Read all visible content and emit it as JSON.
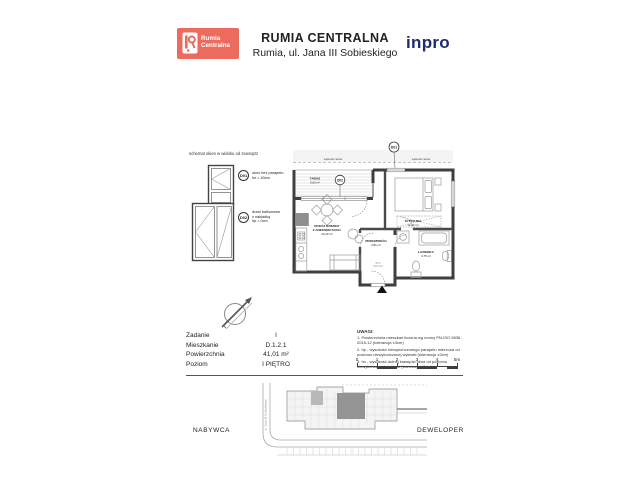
{
  "header": {
    "logo_line1": "Rumia",
    "logo_line2": "Centralna",
    "title": "RUMIA CENTRALNA",
    "subtitle": "Rumia, ul. Jana III Sobieskiego",
    "brand": "inpro"
  },
  "schematics": {
    "caption": "schemat okien w widoku od zewnątrz",
    "win1": {
      "code": "D01",
      "note1": "okno bez parapetu",
      "note2": "hn = 40cm"
    },
    "win2": {
      "code": "D02",
      "note1": "drzwi balkonowe",
      "note2": "z nakładką",
      "note3": "hp = 0cm"
    }
  },
  "plan": {
    "neighbor_left": "sąsiedni taras",
    "neighbor_right": "sąsiedni taras",
    "code_d01": "D01",
    "code_d02": "D02",
    "rooms": {
      "taras": {
        "name": "TARAS",
        "area": "5,60 m²"
      },
      "living": {
        "name1": "POKÓJ DZIENNY",
        "name2": "Z ANEKSEM KUCH.",
        "area": "20,43 m²"
      },
      "sypialnia": {
        "name": "SYPIALNIA",
        "area": "12,02 m²"
      },
      "przedpokoj": {
        "name": "PRZEDPOKÓJ",
        "area": "3,81 m²"
      },
      "lazienka": {
        "name": "ŁAZIENKA",
        "area": "4,75 m²"
      }
    },
    "entrance_line1": "drzwi",
    "entrance_line2": "wejściowe"
  },
  "table": {
    "rows": [
      {
        "label": "Zadanie",
        "value": "I"
      },
      {
        "label": "Mieszkanie",
        "value": "D.1.2.1"
      },
      {
        "label": "Powierzchnia",
        "value": "41,01 m²"
      },
      {
        "label": "Poziom",
        "value": "I PIĘTRO"
      }
    ]
  },
  "notes": {
    "title": "UWAGI:",
    "items": [
      "1. Powierzchnia mieszkań liczona wg normy PN-ISO 9836 : 2015-12 (tolerancja ±3cm)",
      "2. hp - wysokość niewykończonego parapetu mierzona od poziomu niewykończonej wylewki (tolerancja ±2cm)",
      "3. hn - wysokość dolnej krawędzi okna od poziomu niewykończonej wylewki (tolerancja ±2cm)"
    ]
  },
  "scale": {
    "t0": "0",
    "t1": "1",
    "t2": "2",
    "t3": "3",
    "t4": "4",
    "t5": "5m"
  },
  "footer": {
    "buyer": "NABYWCA",
    "developer": "DEWELOPER",
    "street": "ul. Jana III Sobieskiego"
  },
  "colors": {
    "logo_bg": "#ec6a5e",
    "brand_navy": "#1d2d6e",
    "wall": "#3f3f3f",
    "site_highlight": "#949494"
  }
}
